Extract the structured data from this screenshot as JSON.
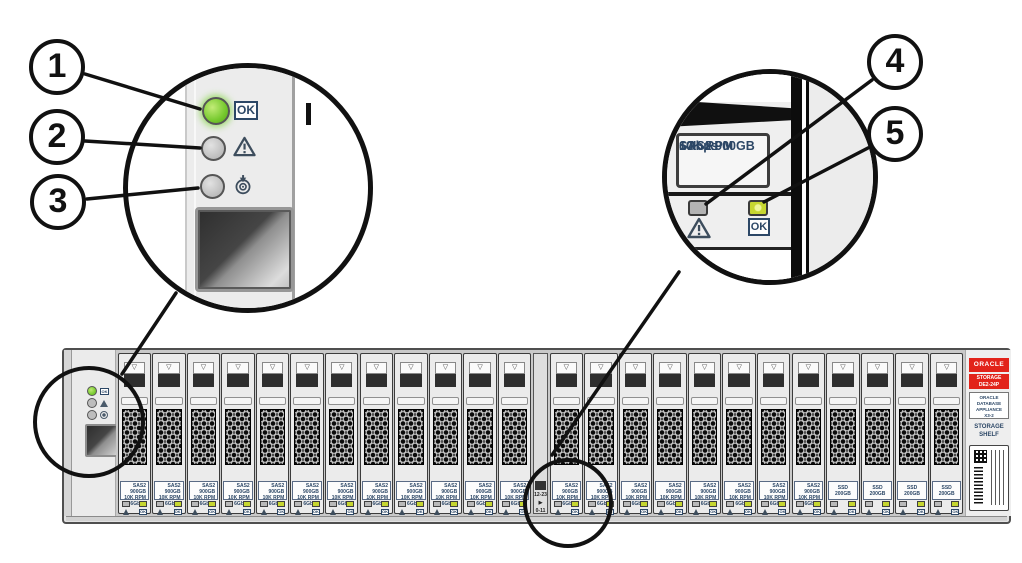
{
  "callouts": [
    "1",
    "2",
    "3",
    "4",
    "5"
  ],
  "left_magnifier": {
    "ok_label": "OK",
    "leds": [
      "power-ok-green",
      "fault-gray",
      "locate-gray"
    ]
  },
  "right_magnifier": {
    "label": [
      "SAS2 900GB",
      "10K RPM",
      "6Gbps"
    ],
    "ok_label": "OK",
    "leds": [
      "fault-gray",
      "ok-green"
    ]
  },
  "shelf": {
    "ok_label": "OK",
    "hdd_label": [
      "SAS2 900GB",
      "10K RPM",
      "6Gbps"
    ],
    "ssd_label": "SSD 200GB",
    "drives": [
      "hdd",
      "hdd",
      "hdd",
      "hdd",
      "hdd",
      "hdd",
      "hdd",
      "hdd",
      "hdd",
      "hdd",
      "hdd",
      "hdd",
      "hdd",
      "hdd",
      "hdd",
      "hdd",
      "hdd",
      "hdd",
      "hdd",
      "hdd",
      "ssd",
      "ssd",
      "ssd",
      "ssd"
    ],
    "divider_after": 12,
    "divider": {
      "range_right": "12-23",
      "arrow_right": "▶",
      "range_left": "0-11",
      "arrow_left": "◀"
    },
    "right_panel": {
      "brand": "ORACLE",
      "model": [
        "STORAGE",
        "DE2-24P"
      ],
      "product": [
        "ORACLE",
        "DATABASE",
        "APPLIANCE",
        "X3-2"
      ],
      "type": [
        "STORAGE",
        "SHELF"
      ]
    }
  },
  "icons": {
    "latch_arrow": "▽",
    "ok": "OK"
  },
  "colors": {
    "ok_green": "#76c92e",
    "led_green": "#c6d631",
    "fault_gray": "#bdbdbd",
    "oracle_red": "#e2231a",
    "label_blue": "#2c4766",
    "line_black": "#111111"
  }
}
